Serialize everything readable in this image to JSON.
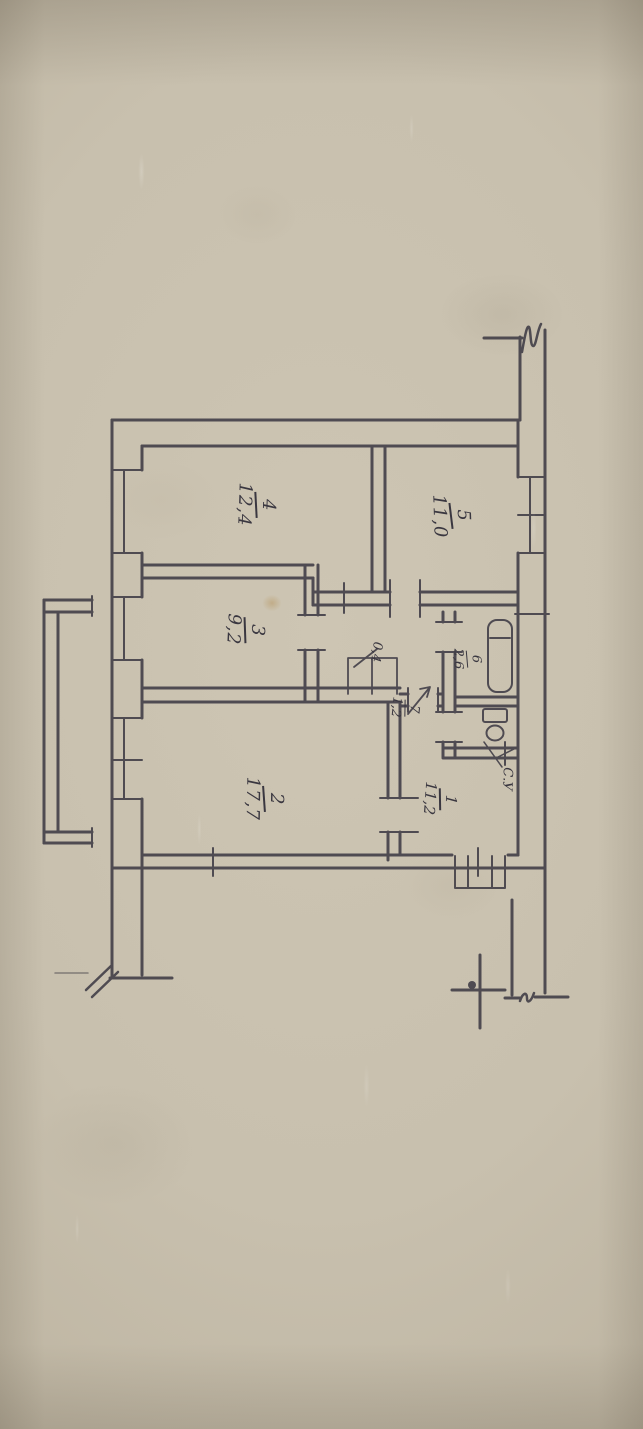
{
  "photo": {
    "description": "hand-drawn apartment floor plan on aged beige paper, drawing rotated 90 degrees",
    "paper_color": "#c8c0ae",
    "ink_color": "#3a3740"
  },
  "plan": {
    "type": "apartment-floor-plan",
    "rooms": [
      {
        "number": "4",
        "area": "12,4"
      },
      {
        "number": "5",
        "area": "11,0"
      },
      {
        "number": "3",
        "area": "9,2"
      },
      {
        "number": "2",
        "area": "17,7"
      },
      {
        "number": "6",
        "area": "2,6"
      },
      {
        "number": "7",
        "area": "1,2"
      },
      {
        "number": "1",
        "area": "11,2"
      }
    ],
    "annotations": [
      {
        "text": "0,4"
      },
      {
        "text": "С.У"
      }
    ]
  }
}
